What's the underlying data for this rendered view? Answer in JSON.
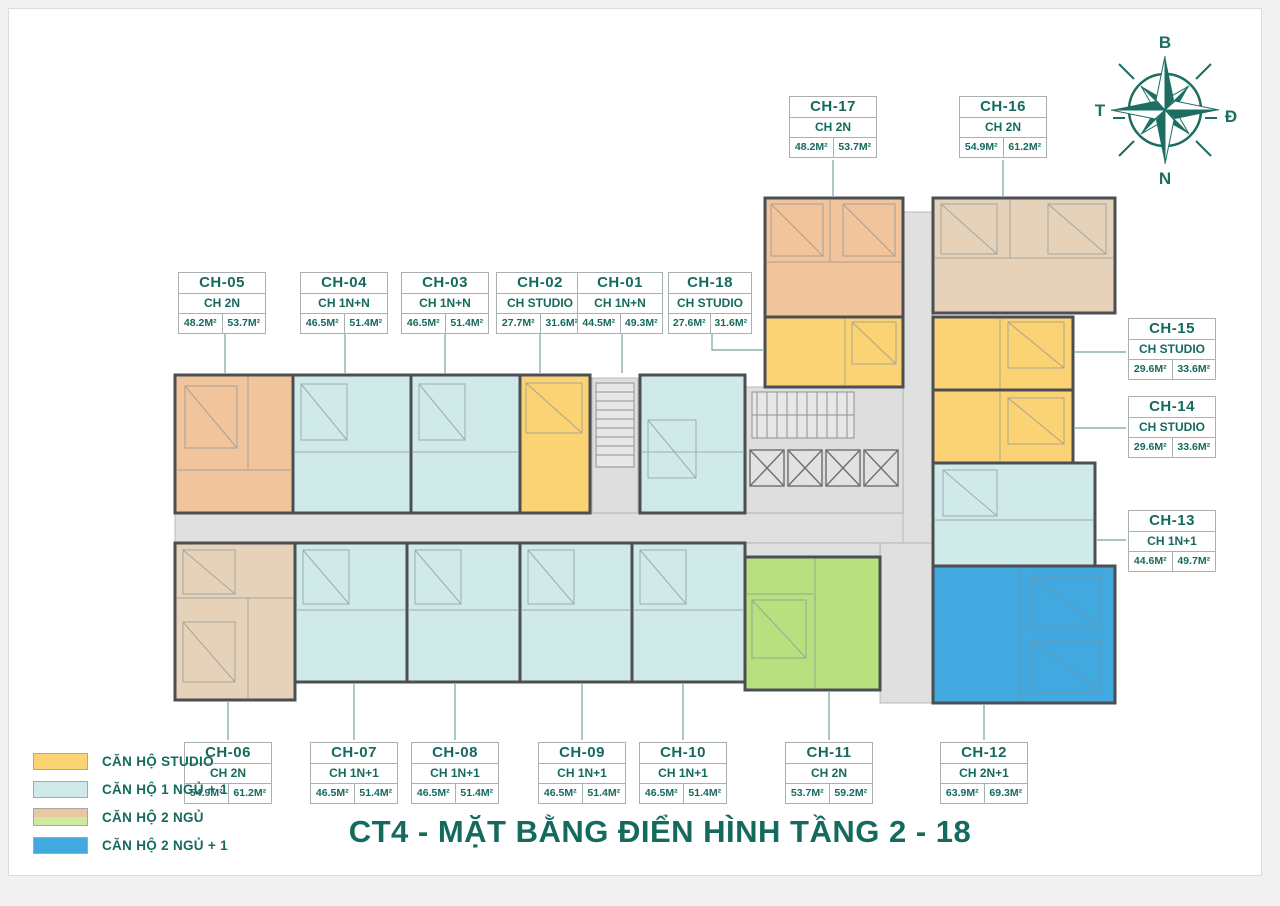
{
  "title": "CT4 - MẶT BẰNG ĐIỂN HÌNH TẦNG 2 - 18",
  "compass": {
    "north_label": "B",
    "east_label": "Đ",
    "south_label": "N",
    "west_label": "T"
  },
  "palette": {
    "studio": "#fbd274",
    "one_bed": "#cfeae8",
    "two_bed_orange": "#f2c49c",
    "two_bed_tan": "#e6d2b8",
    "two_bed_green": "#b9e07f",
    "two_bed_plus_blue": "#41a9e0",
    "corridor": "#e0e0e0",
    "accent_teal": "#156a5e"
  },
  "legend": {
    "items": [
      {
        "label": "CĂN HỘ STUDIO",
        "colors": [
          "#fbd274"
        ]
      },
      {
        "label": "CĂN HỘ 1 NGỦ + 1",
        "colors": [
          "#cfeae8"
        ]
      },
      {
        "label": "CĂN HỘ 2 NGỦ",
        "colors": [
          "#eac7a3",
          "#cfe9a0"
        ]
      },
      {
        "label": "CĂN HỘ 2 NGỦ + 1",
        "colors": [
          "#41a9e0"
        ]
      }
    ]
  },
  "units": [
    {
      "id": "CH-01",
      "type": "CH 1N+N",
      "area1": "44.5M²",
      "area2": "49.3M²"
    },
    {
      "id": "CH-02",
      "type": "CH STUDIO",
      "area1": "27.7M²",
      "area2": "31.6M²"
    },
    {
      "id": "CH-03",
      "type": "CH 1N+N",
      "area1": "46.5M²",
      "area2": "51.4M²"
    },
    {
      "id": "CH-04",
      "type": "CH 1N+N",
      "area1": "46.5M²",
      "area2": "51.4M²"
    },
    {
      "id": "CH-05",
      "type": "CH 2N",
      "area1": "48.2M²",
      "area2": "53.7M²"
    },
    {
      "id": "CH-06",
      "type": "CH 2N",
      "area1": "54.9M²",
      "area2": "61.2M²"
    },
    {
      "id": "CH-07",
      "type": "CH 1N+1",
      "area1": "46.5M²",
      "area2": "51.4M²"
    },
    {
      "id": "CH-08",
      "type": "CH 1N+1",
      "area1": "46.5M²",
      "area2": "51.4M²"
    },
    {
      "id": "CH-09",
      "type": "CH 1N+1",
      "area1": "46.5M²",
      "area2": "51.4M²"
    },
    {
      "id": "CH-10",
      "type": "CH 1N+1",
      "area1": "46.5M²",
      "area2": "51.4M²"
    },
    {
      "id": "CH-11",
      "type": "CH 2N",
      "area1": "53.7M²",
      "area2": "59.2M²"
    },
    {
      "id": "CH-12",
      "type": "CH 2N+1",
      "area1": "63.9M²",
      "area2": "69.3M²"
    },
    {
      "id": "CH-13",
      "type": "CH 1N+1",
      "area1": "44.6M²",
      "area2": "49.7M²"
    },
    {
      "id": "CH-14",
      "type": "CH STUDIO",
      "area1": "29.6M²",
      "area2": "33.6M²"
    },
    {
      "id": "CH-15",
      "type": "CH STUDIO",
      "area1": "29.6M²",
      "area2": "33.6M²"
    },
    {
      "id": "CH-16",
      "type": "CH 2N",
      "area1": "54.9M²",
      "area2": "61.2M²"
    },
    {
      "id": "CH-17",
      "type": "CH 2N",
      "area1": "48.2M²",
      "area2": "53.7M²"
    },
    {
      "id": "CH-18",
      "type": "CH STUDIO",
      "area1": "27.6M²",
      "area2": "31.6M²"
    }
  ]
}
